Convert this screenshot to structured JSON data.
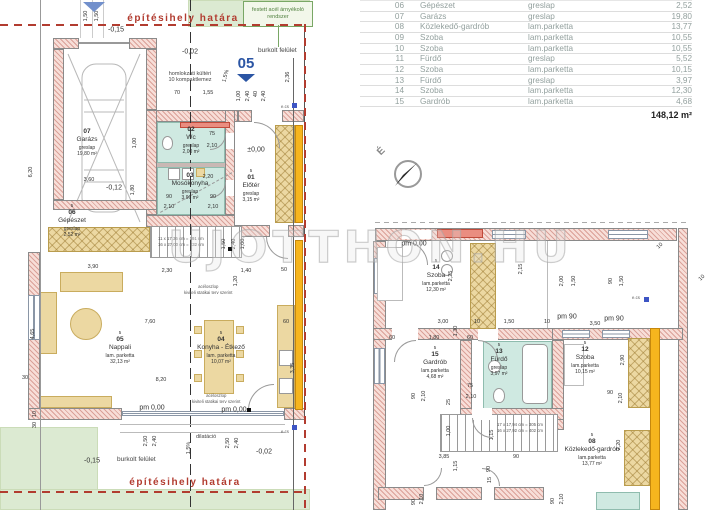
{
  "table": {
    "rows": [
      {
        "no": "06",
        "name": "Gépészet",
        "floor": "greslap",
        "area": "2,52"
      },
      {
        "no": "07",
        "name": "Garázs",
        "floor": "greslap",
        "area": "19,80"
      },
      {
        "no": "08",
        "name": "Közlekedő-gardrób",
        "floor": "lam.parketta",
        "area": "13,77"
      },
      {
        "no": "09",
        "name": "Szoba",
        "floor": "lam.parketta",
        "area": "10,55"
      },
      {
        "no": "10",
        "name": "Szoba",
        "floor": "lam.parketta",
        "area": "10,55"
      },
      {
        "no": "11",
        "name": "Fürdő",
        "floor": "greslap",
        "area": "5,52"
      },
      {
        "no": "12",
        "name": "Szoba",
        "floor": "lam.parketta",
        "area": "10,15"
      },
      {
        "no": "13",
        "name": "Fürdő",
        "floor": "greslap",
        "area": "3,97"
      },
      {
        "no": "14",
        "name": "Szoba",
        "floor": "lam.parketta",
        "area": "12,30"
      },
      {
        "no": "15",
        "name": "Gardrób",
        "floor": "lam.parketta",
        "area": "4,68"
      }
    ],
    "total": "148,12 m²"
  },
  "watermark": "UJOTTHON.HU",
  "compass_label": "É",
  "section_marker": "05",
  "notes": {
    "boundary": "építésihely határa",
    "festett": "festett acél árnyékoló rendszer",
    "burkolt": "burkolt felület",
    "homlokzati1": "homlokzati kültéri",
    "homlokzati2": "10 kompaktlemez",
    "acel1": "acéloszlop",
    "acel2": "kiviteli statikai terv szerint",
    "dilatacio": "dilatáció",
    "stair_l1": "11 x 17,36 cm = 191 cm",
    "stair_l2": "16 x 27,00 cm = 432 cm",
    "stair_r1": "17 x 17,94 cm = 305 cm",
    "stair_r2": "16 x 27,92 cm = 402 cm",
    "ecs": "e.cs"
  },
  "rooms": [
    {
      "no": "02",
      "name": "Wc",
      "floor": "greslap",
      "area": "2,00 m²",
      "cx": 191,
      "y": 126
    },
    {
      "no": "03",
      "name": "Mosókonyha",
      "floor": "greslap",
      "area": "3,96 m²",
      "cx": 190,
      "y": 172
    },
    {
      "no": "07",
      "name": "Garázs",
      "floor": "greslap",
      "area": "19,80 m²",
      "cx": 87,
      "y": 128
    },
    {
      "storey": "5",
      "no": "06",
      "name": "Gépészet",
      "floor": "greslap",
      "area": "2,52 m²",
      "cx": 72,
      "y": 203
    },
    {
      "storey": "5",
      "no": "01",
      "name": "Előtér",
      "floor": "greslap",
      "area": "3,15 m²",
      "cx": 251,
      "y": 168
    },
    {
      "storey": "5",
      "no": "05",
      "name": "Nappali",
      "floor": "lam. parketta",
      "area": "32,13 m²",
      "cx": 120,
      "y": 330
    },
    {
      "storey": "5",
      "no": "04",
      "name": "Konyha - Étkező",
      "floor": "lam. parketta",
      "area": "10,07 m²",
      "cx": 221,
      "y": 330
    },
    {
      "storey": "5",
      "no": "14",
      "name": "Szoba",
      "floor": "lam.parketta",
      "area": "12,30 m²",
      "cx": 436,
      "y": 258
    },
    {
      "storey": "5",
      "no": "15",
      "name": "Gardrób",
      "floor": "lam.parketta",
      "area": "4,68 m²",
      "cx": 435,
      "y": 345
    },
    {
      "storey": "5",
      "no": "13",
      "name": "Fürdő",
      "floor": "greslap",
      "area": "3,97 m²",
      "cx": 499,
      "y": 342
    },
    {
      "storey": "5",
      "no": "12",
      "name": "Szoba",
      "floor": "lam.parketta",
      "area": "10,15 m²",
      "cx": 585,
      "y": 340
    },
    {
      "storey": "5",
      "no": "08",
      "name": "Közlekedő-gardrób",
      "floor": "lam.parketta",
      "area": "13,77 m²",
      "cx": 592,
      "y": 432
    }
  ],
  "dim_labels": [
    {
      "t": "1,50",
      "x": 86,
      "y": 16,
      "r": -90
    },
    {
      "t": "1,50",
      "x": 97,
      "y": 16,
      "r": -90
    },
    {
      "t": "-0,15",
      "x": 116,
      "y": 30,
      "s": 7
    },
    {
      "t": "6,20",
      "x": 31,
      "y": 172,
      "r": -90
    },
    {
      "t": "-0,02",
      "x": 190,
      "y": 52,
      "s": 7
    },
    {
      "t": "2,36",
      "x": 288,
      "y": 77,
      "r": -90
    },
    {
      "t": "1,5%",
      "x": 226,
      "y": 76,
      "r": -75
    },
    {
      "t": "70",
      "x": 177,
      "y": 93
    },
    {
      "t": "1,55",
      "x": 208,
      "y": 93
    },
    {
      "t": "1,00",
      "x": 239,
      "y": 96,
      "r": -90
    },
    {
      "t": "2,40",
      "x": 248,
      "y": 96,
      "r": -90
    },
    {
      "t": "40",
      "x": 256,
      "y": 94,
      "r": -90
    },
    {
      "t": "2,40",
      "x": 264,
      "y": 96,
      "r": -90
    },
    {
      "t": "75",
      "x": 212,
      "y": 134
    },
    {
      "t": "2,10",
      "x": 212,
      "y": 146
    },
    {
      "t": "±0,00",
      "x": 256,
      "y": 150,
      "s": 7
    },
    {
      "t": "3,60",
      "x": 89,
      "y": 180
    },
    {
      "t": "-0,12",
      "x": 114,
      "y": 188,
      "s": 7
    },
    {
      "t": "1,00",
      "x": 135,
      "y": 143,
      "r": -90
    },
    {
      "t": "1,80",
      "x": 133,
      "y": 190,
      "r": -90
    },
    {
      "t": "2,20",
      "x": 208,
      "y": 177
    },
    {
      "t": "90",
      "x": 169,
      "y": 197
    },
    {
      "t": "2,10",
      "x": 169,
      "y": 207
    },
    {
      "t": "90",
      "x": 213,
      "y": 197
    },
    {
      "t": "2,10",
      "x": 213,
      "y": 207
    },
    {
      "t": "3,90",
      "x": 93,
      "y": 267
    },
    {
      "t": "2,30",
      "x": 167,
      "y": 271
    },
    {
      "t": "1,40",
      "x": 246,
      "y": 271
    },
    {
      "t": "50",
      "x": 284,
      "y": 270
    },
    {
      "t": "1,50",
      "x": 224,
      "y": 244,
      "r": -90
    },
    {
      "t": "2,40",
      "x": 234,
      "y": 244,
      "r": -90
    },
    {
      "t": "1,00",
      "x": 243,
      "y": 244,
      "r": -90
    },
    {
      "t": "1,20",
      "x": 236,
      "y": 281,
      "r": -90
    },
    {
      "t": "4,65",
      "x": 33,
      "y": 334,
      "r": -90
    },
    {
      "t": "7,60",
      "x": 150,
      "y": 322
    },
    {
      "t": "8,20",
      "x": 161,
      "y": 380
    },
    {
      "t": "30",
      "x": 25,
      "y": 378
    },
    {
      "t": "3,35",
      "x": 293,
      "y": 368,
      "r": -90
    },
    {
      "t": "60",
      "x": 286,
      "y": 322
    },
    {
      "t": "pm 0,00",
      "x": 152,
      "y": 408,
      "s": 7
    },
    {
      "t": "pm 0,00",
      "x": 234,
      "y": 410,
      "s": 7
    },
    {
      "t": "2,50",
      "x": 146,
      "y": 441,
      "r": -90
    },
    {
      "t": "2,40",
      "x": 155,
      "y": 441,
      "r": -90
    },
    {
      "t": "2,50",
      "x": 228,
      "y": 443,
      "r": -90
    },
    {
      "t": "2,40",
      "x": 237,
      "y": 443,
      "r": -90
    },
    {
      "t": "1,5%",
      "x": 189,
      "y": 448,
      "r": -90
    },
    {
      "t": "-0,15",
      "x": 92,
      "y": 461,
      "s": 7
    },
    {
      "t": "-0,02",
      "x": 264,
      "y": 452,
      "s": 7
    },
    {
      "t": "10",
      "x": 35,
      "y": 414,
      "r": -90
    },
    {
      "t": "30",
      "x": 35,
      "y": 425,
      "r": -90
    },
    {
      "t": "pm 0,00",
      "x": 414,
      "y": 244,
      "s": 7
    },
    {
      "t": "2,25",
      "x": 451,
      "y": 276,
      "r": -90
    },
    {
      "t": "2,15",
      "x": 521,
      "y": 269,
      "r": -90
    },
    {
      "t": "3,00",
      "x": 443,
      "y": 322
    },
    {
      "t": "10",
      "x": 477,
      "y": 322
    },
    {
      "t": "1,50",
      "x": 509,
      "y": 322
    },
    {
      "t": "10",
      "x": 547,
      "y": 322
    },
    {
      "t": "60",
      "x": 392,
      "y": 338
    },
    {
      "t": "1,80",
      "x": 434,
      "y": 338
    },
    {
      "t": "60",
      "x": 470,
      "y": 338
    },
    {
      "t": "1,30",
      "x": 456,
      "y": 331,
      "r": -90
    },
    {
      "t": "75",
      "x": 470,
      "y": 386
    },
    {
      "t": "2,10",
      "x": 471,
      "y": 397
    },
    {
      "t": "25",
      "x": 449,
      "y": 402,
      "r": -90
    },
    {
      "t": "90",
      "x": 414,
      "y": 396,
      "r": -90
    },
    {
      "t": "2,10",
      "x": 424,
      "y": 396,
      "r": -90
    },
    {
      "t": "1,00",
      "x": 449,
      "y": 431,
      "r": -90
    },
    {
      "t": "1,15",
      "x": 492,
      "y": 435,
      "r": -90
    },
    {
      "t": "3,85",
      "x": 444,
      "y": 457
    },
    {
      "t": "1,15",
      "x": 456,
      "y": 466,
      "r": -90
    },
    {
      "t": "90",
      "x": 489,
      "y": 469,
      "r": -90
    },
    {
      "t": "90",
      "x": 516,
      "y": 457
    },
    {
      "t": "15",
      "x": 490,
      "y": 480,
      "r": -90
    },
    {
      "t": "90",
      "x": 414,
      "y": 502,
      "r": -90
    },
    {
      "t": "2,10",
      "x": 422,
      "y": 499,
      "r": -90
    },
    {
      "t": "90",
      "x": 553,
      "y": 501,
      "r": -90
    },
    {
      "t": "2,10",
      "x": 562,
      "y": 499,
      "r": -90
    },
    {
      "t": "pm 90",
      "x": 567,
      "y": 317,
      "s": 7
    },
    {
      "t": "pm 90",
      "x": 614,
      "y": 319,
      "s": 7
    },
    {
      "t": "3,50",
      "x": 595,
      "y": 324
    },
    {
      "t": "2,90",
      "x": 623,
      "y": 360,
      "r": -90
    },
    {
      "t": "90",
      "x": 610,
      "y": 393
    },
    {
      "t": "2,10",
      "x": 621,
      "y": 398,
      "r": -90
    },
    {
      "t": "2,20",
      "x": 619,
      "y": 445,
      "r": -90
    },
    {
      "t": "2,00",
      "x": 562,
      "y": 281,
      "r": -90
    },
    {
      "t": "1,50",
      "x": 574,
      "y": 281,
      "r": -90
    },
    {
      "t": "90",
      "x": 611,
      "y": 281,
      "r": -90
    },
    {
      "t": "1,50",
      "x": 622,
      "y": 281,
      "r": -90
    },
    {
      "t": "10",
      "x": 702,
      "y": 278,
      "r": -45
    },
    {
      "t": "10",
      "x": 660,
      "y": 246,
      "r": -45
    }
  ]
}
